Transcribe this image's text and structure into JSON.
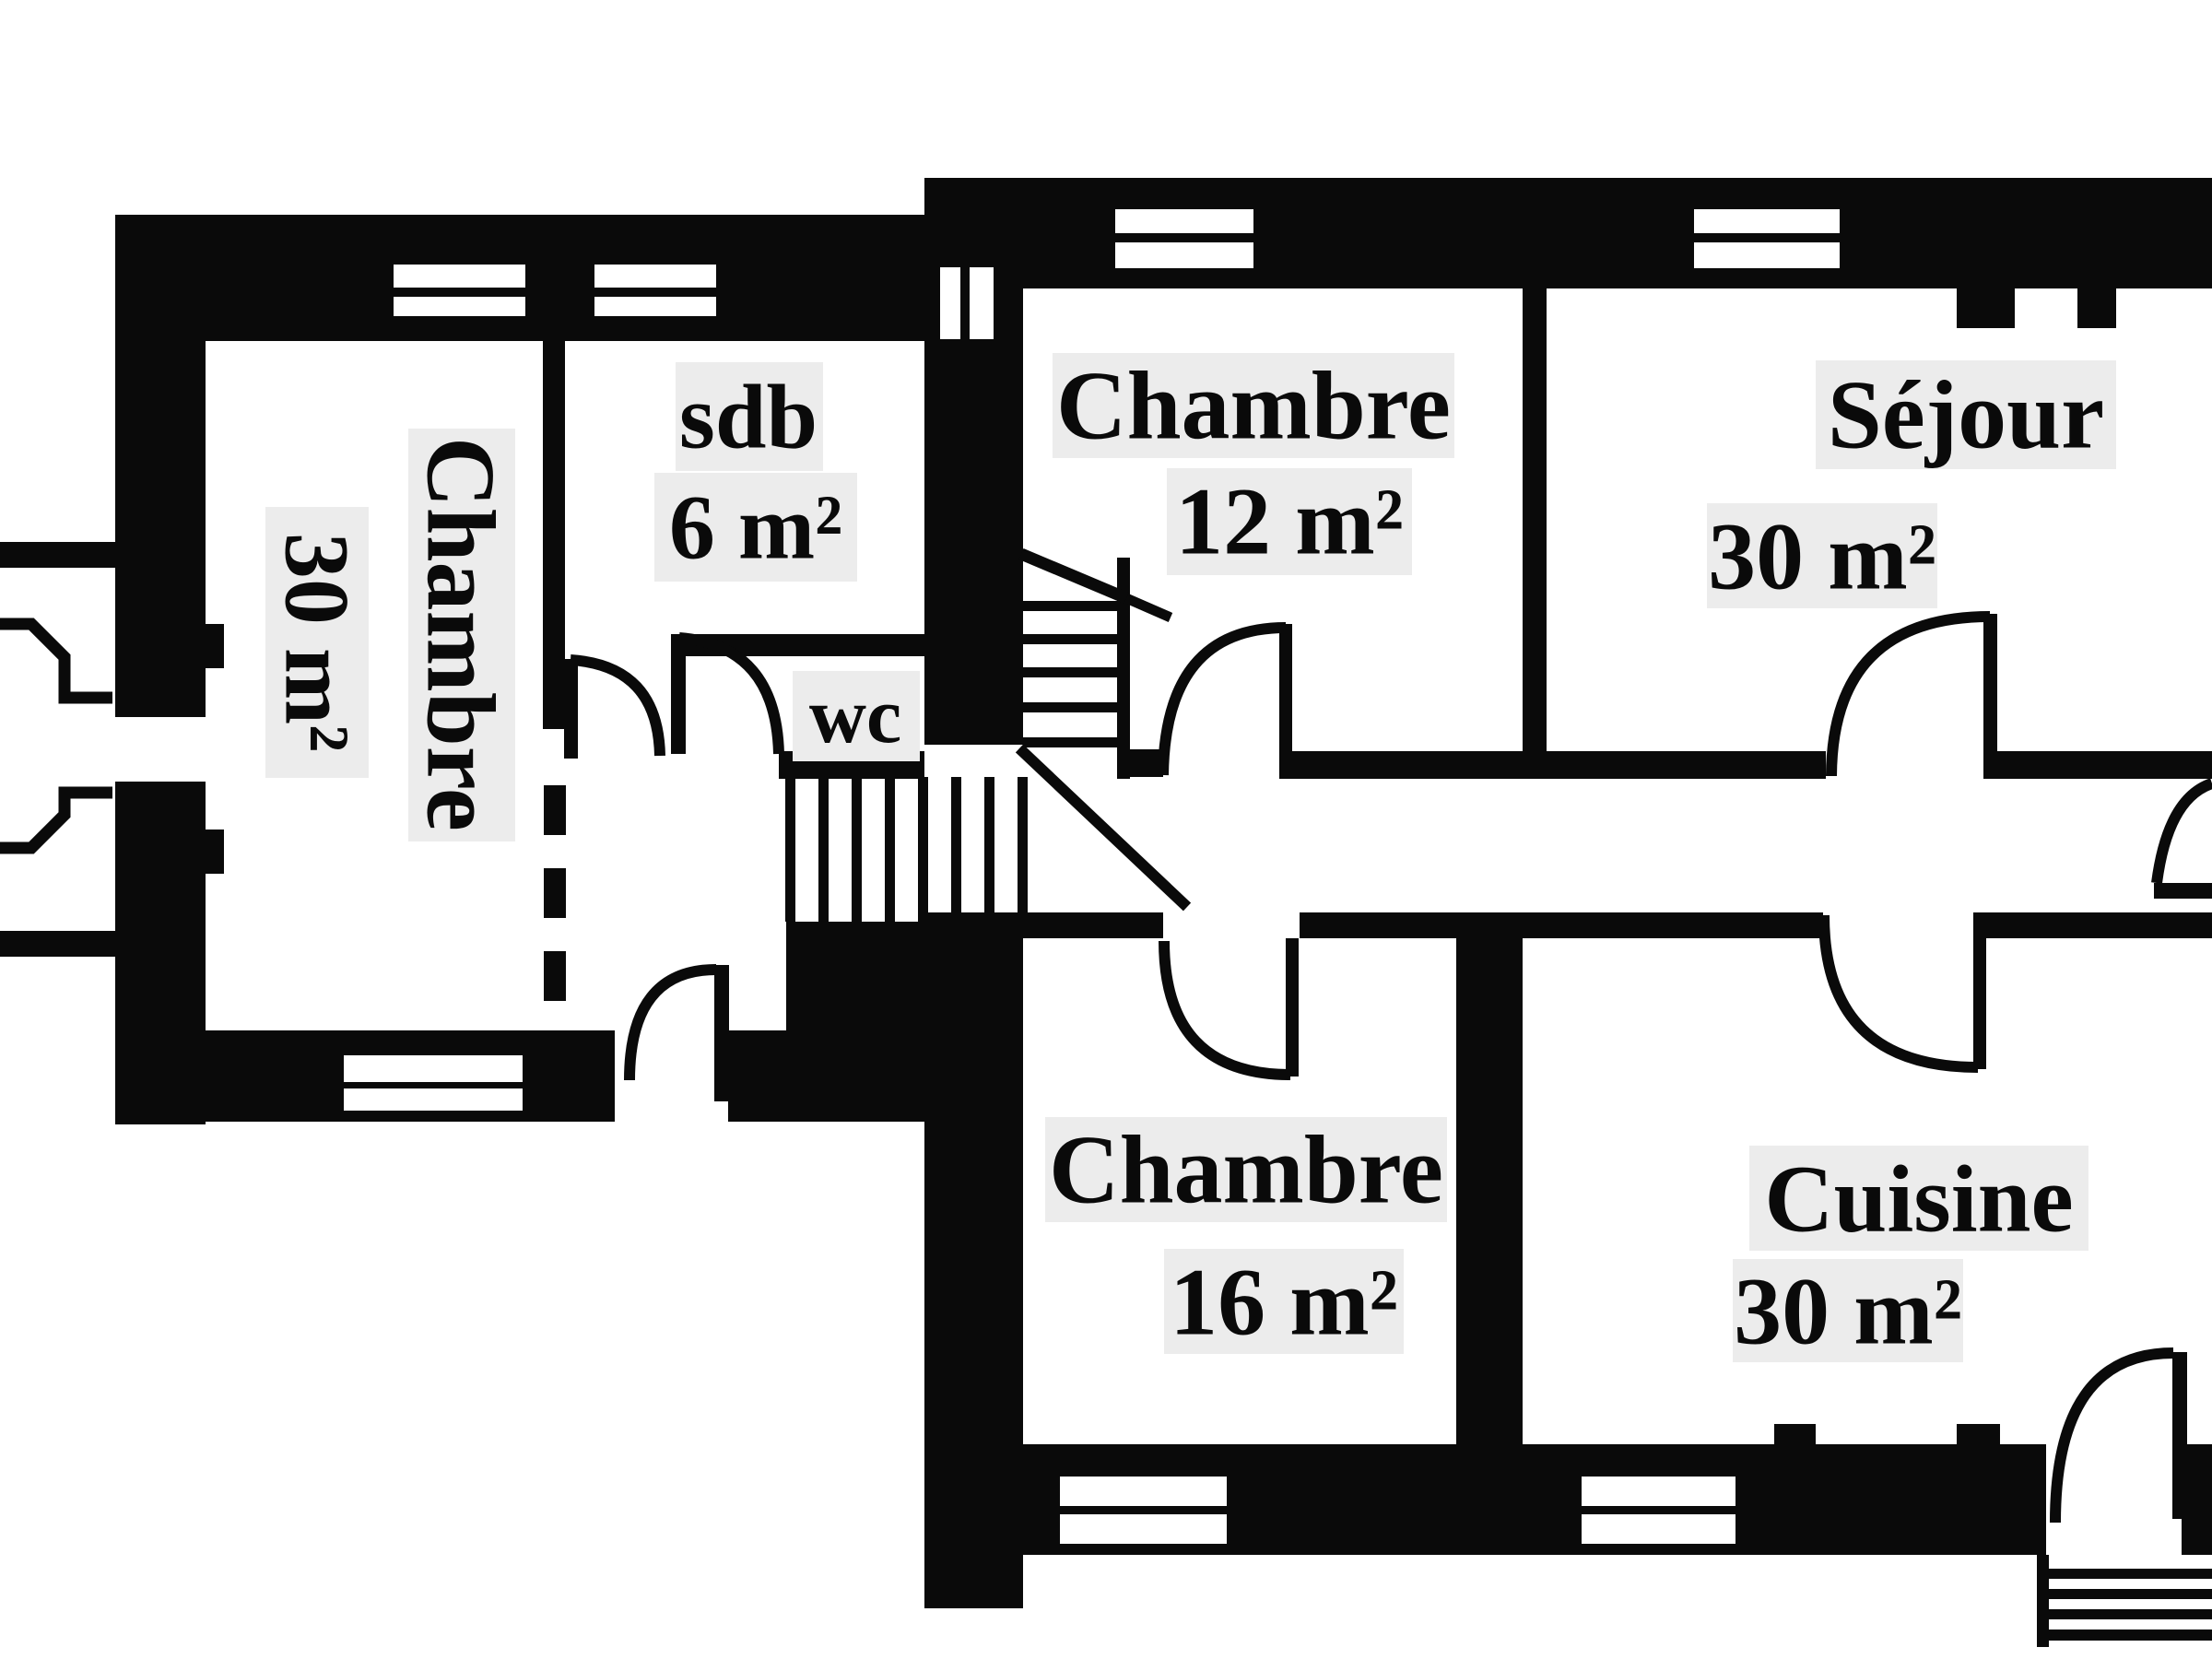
{
  "meta": {
    "type": "floor-plan",
    "language": "fr",
    "ink": "#0a0a0a",
    "background": "#ffffff",
    "label_halo": "#ececec"
  },
  "rooms": [
    {
      "id": "chambre-30",
      "name": "Chambre",
      "area": "30 m²"
    },
    {
      "id": "sdb",
      "name": "sdb",
      "area": "6 m²"
    },
    {
      "id": "wc",
      "name": "wc",
      "area": ""
    },
    {
      "id": "chambre-12",
      "name": "Chambre",
      "area": "12 m²"
    },
    {
      "id": "sejour",
      "name": "Séjour",
      "area": "30 m²"
    },
    {
      "id": "chambre-16",
      "name": "Chambre",
      "area": "16 m²"
    },
    {
      "id": "cuisine",
      "name": "Cuisine",
      "area": "30 m²"
    }
  ]
}
